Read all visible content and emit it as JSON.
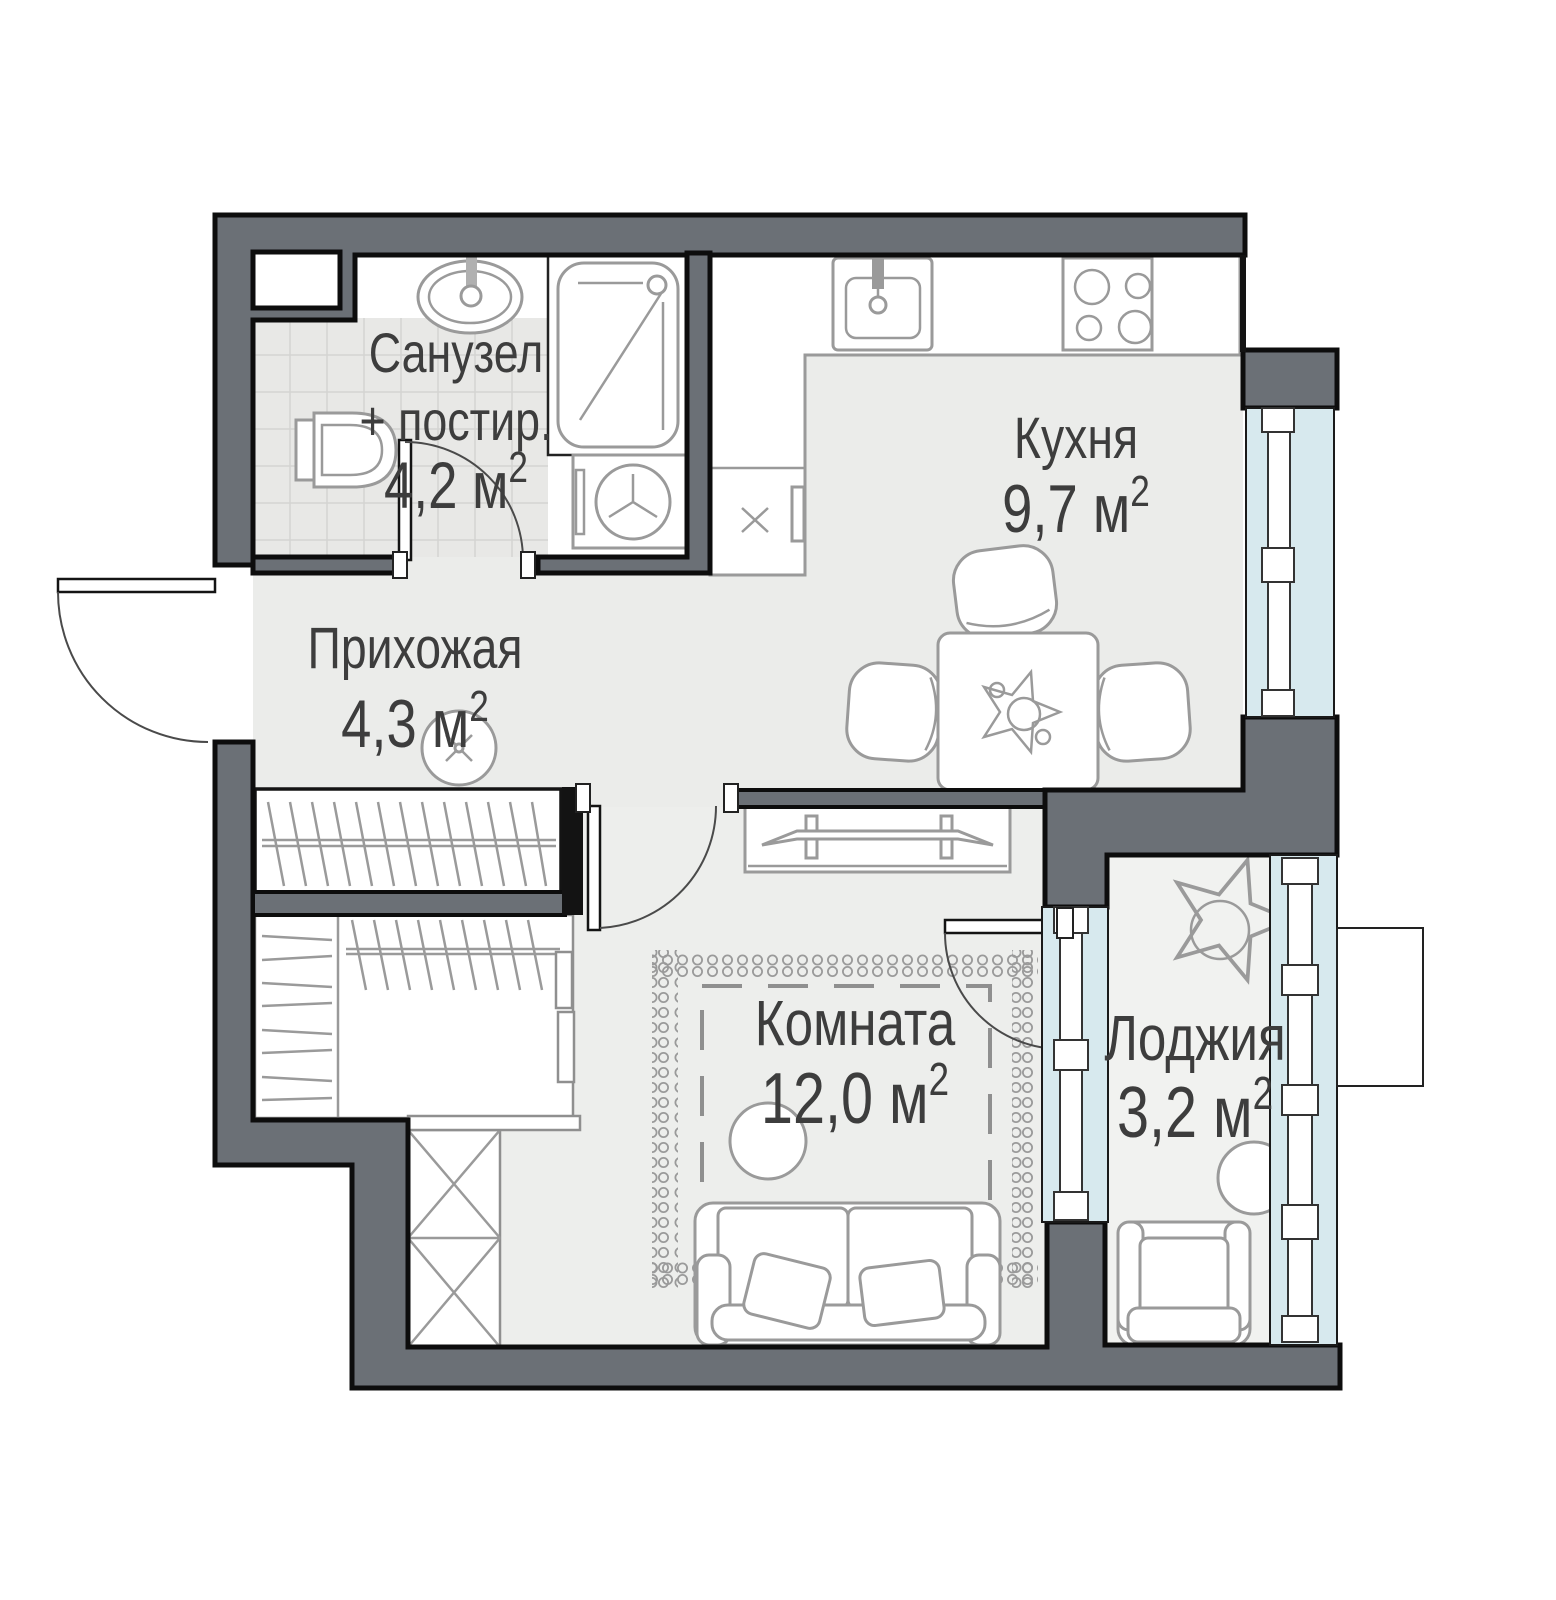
{
  "plan": {
    "type": "apartment-floor-plan",
    "rooms": {
      "bathroom": {
        "name_line1": "Санузел",
        "name_line2": "+ постир.",
        "area": "4,2 м",
        "area_sup": "2"
      },
      "kitchen": {
        "name": "Кухня",
        "area": "9,7 м",
        "area_sup": "2"
      },
      "hallway": {
        "name": "Прихожая",
        "area": "4,3 м",
        "area_sup": "2"
      },
      "living_room": {
        "name": "Комната",
        "area": "12,0 м",
        "area_sup": "2"
      },
      "loggia": {
        "name": "Лоджия",
        "area": "3,2 м",
        "area_sup": "2"
      }
    },
    "symbols": [
      "entrance-door",
      "interior-door",
      "balcony-door",
      "window",
      "toilet",
      "bathroom-sink",
      "shower",
      "washing-machine",
      "kitchen-sink",
      "stove",
      "kitchen-cabinet",
      "dining-table",
      "chair",
      "table-plant",
      "ceiling-light",
      "wardrobe-hangers",
      "wardrobe-shelves",
      "x-wardrobe",
      "tv-console",
      "tv",
      "carpet",
      "sofa",
      "pillow",
      "pouf",
      "loggia-plant",
      "armchair",
      "side-table",
      "ac-basket"
    ],
    "colors": {
      "wall": "#6b7076",
      "outline": "#0d0d0d",
      "glazing": "#d7e9ee",
      "floor": "#ebecea",
      "tile": "#e8e8e6",
      "furniture_stroke": "#9a9a9a",
      "label_text": "#3d3d3d"
    }
  }
}
